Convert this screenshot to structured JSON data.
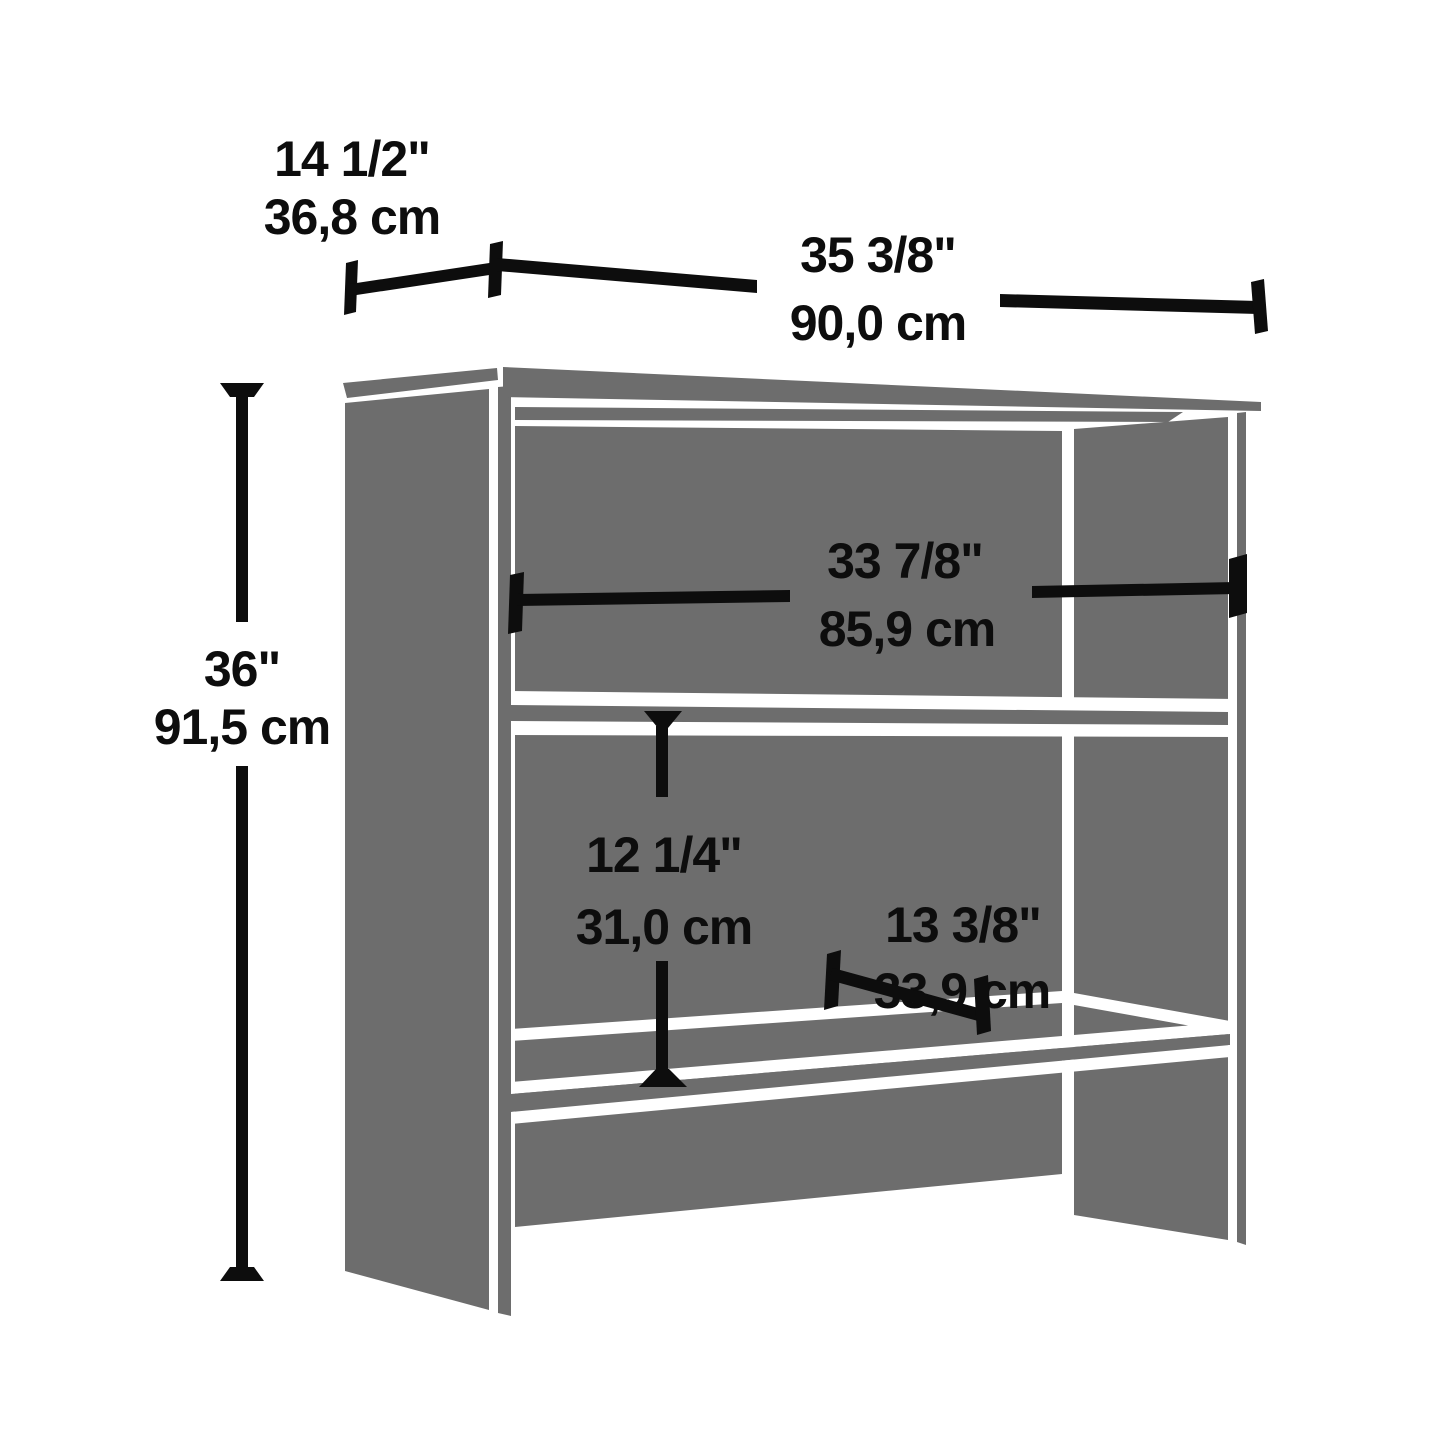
{
  "diagram": {
    "type": "product-dimension-line-drawing",
    "subject": "two-shelf bookcase hutch",
    "colors": {
      "panel_gray": "#6d6d6d",
      "outline_white": "#ffffff",
      "dimension_black": "#0d0d0d",
      "background": "#ffffff"
    },
    "dimensions": [
      {
        "name": "overall-depth",
        "inches": "14 1/2\"",
        "cm": "36,8 cm"
      },
      {
        "name": "overall-width",
        "inches": "35 3/8\"",
        "cm": "90,0 cm"
      },
      {
        "name": "overall-height",
        "inches": "36\"",
        "cm": "91,5 cm"
      },
      {
        "name": "interior-width",
        "inches": "33 7/8\"",
        "cm": "85,9 cm"
      },
      {
        "name": "shelf-opening-height",
        "inches": "12 1/4\"",
        "cm": "31,0 cm"
      },
      {
        "name": "shelf-depth",
        "inches": "13 3/8\"",
        "cm": "33,9 cm"
      }
    ]
  }
}
